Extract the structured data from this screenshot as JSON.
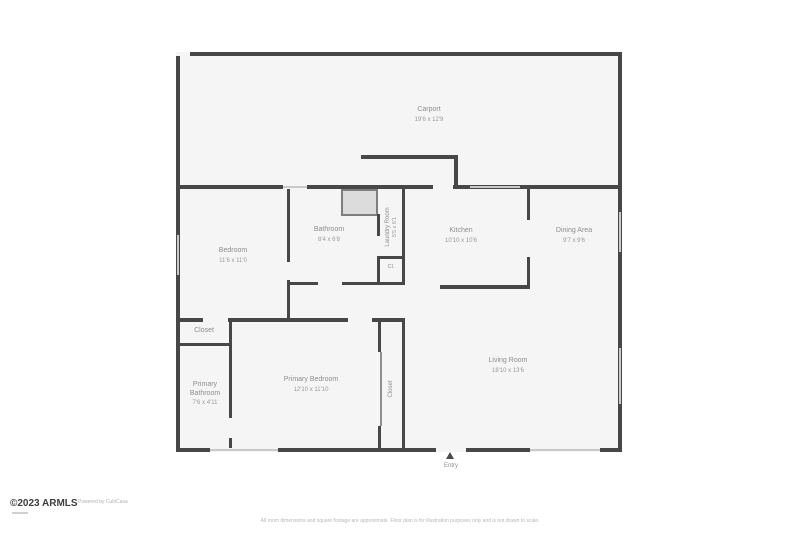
{
  "rooms": {
    "carport": {
      "name": "Carport",
      "dims": "19'6 x 12'9"
    },
    "bedroom": {
      "name": "Bedroom",
      "dims": "11'6 x 11'0"
    },
    "bathroom": {
      "name": "Bathroom",
      "dims": "8'4 x 6'8"
    },
    "laundry": {
      "name": "Laundry Room",
      "dims": "5'5 x 6'1"
    },
    "hall_closet": {
      "name": "Cl."
    },
    "kitchen": {
      "name": "Kitchen",
      "dims": "10'10 x 10'6"
    },
    "dining": {
      "name": "Dining Area",
      "dims": "9'7 x 9'6"
    },
    "living": {
      "name": "Living Room",
      "dims": "18'10 x 13'6"
    },
    "primary_bedroom": {
      "name": "Primary Bedroom",
      "dims": "12'10 x 11'10"
    },
    "primary_bathroom": {
      "name_line1": "Primary",
      "name_line2": "Bathroom",
      "dims": "7'6 x 4'11"
    },
    "closet": {
      "name": "Closet"
    },
    "wardrobe": {
      "name": "Closet"
    }
  },
  "entry": {
    "label": "Entry"
  },
  "footer": {
    "brand": "©2023 ARMLS",
    "brand_note": "Powered by CubiCasa",
    "disclaimer": "All room dimensions and square footage are approximate. Floor plan is for illustration purposes only and is not drawn to scale."
  },
  "colors": {
    "wall": "#474747",
    "floor": "#f5f5f5",
    "window": "#c9c9c9",
    "label": "#8d8d8d"
  }
}
